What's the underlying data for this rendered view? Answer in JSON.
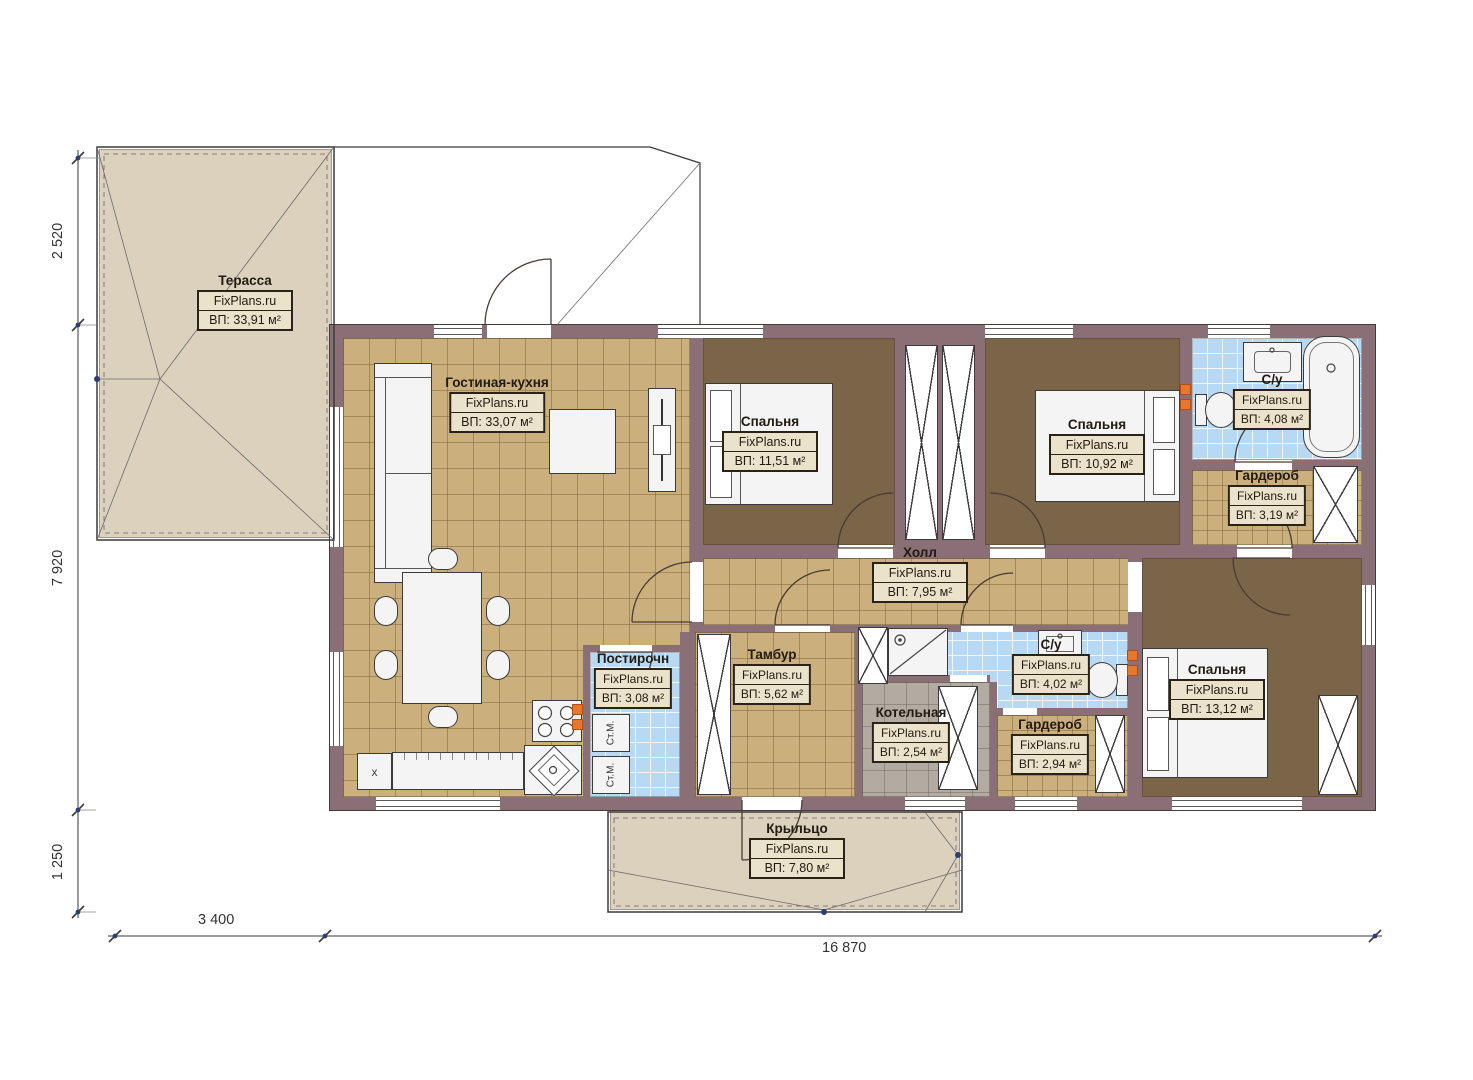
{
  "plan": {
    "watermark": "FixPlans.ru",
    "rooms": [
      {
        "id": "terrace",
        "name": "Терасса",
        "area": "ВП: 33,91 м²"
      },
      {
        "id": "living",
        "name": "Гостиная-кухня",
        "area": "ВП: 33,07 м²"
      },
      {
        "id": "bedroom1",
        "name": "Спальня",
        "area": "ВП: 11,51 м²"
      },
      {
        "id": "bedroom2",
        "name": "Спальня",
        "area": "ВП: 10,92 м²"
      },
      {
        "id": "bath1",
        "name": "С/у",
        "area": "ВП: 4,08 м²"
      },
      {
        "id": "wardrobe1",
        "name": "Гардероб",
        "area": "ВП: 3,19 м²"
      },
      {
        "id": "hall",
        "name": "Холл",
        "area": "ВП: 7,95 м²"
      },
      {
        "id": "laundry",
        "name": "Постирочн",
        "area": "ВП: 3,08 м²"
      },
      {
        "id": "vestibule",
        "name": "Тамбур",
        "area": "ВП: 5,62 м²"
      },
      {
        "id": "boiler",
        "name": "Котельная",
        "area": "ВП: 2,54 м²"
      },
      {
        "id": "bath2",
        "name": "С/у",
        "area": "ВП: 4,02 м²"
      },
      {
        "id": "wardrobe2",
        "name": "Гардероб",
        "area": "ВП: 2,94 м²"
      },
      {
        "id": "bedroom3",
        "name": "Спальня",
        "area": "ВП: 13,12 м²"
      },
      {
        "id": "porch",
        "name": "Крыльцо",
        "area": "ВП: 7,80 м²"
      }
    ],
    "dimensions": {
      "left": [
        "2 520",
        "7 920",
        "1 250"
      ],
      "bottom": [
        "3 400",
        "16 870"
      ]
    },
    "labels": {
      "washer": "Ст.М.",
      "cabinet": "x"
    }
  },
  "colors": {
    "wall": "#8a7076",
    "floor_tan": "#cbb07e",
    "floor_tan_line": "#7a60347f",
    "floor_dark": "#7a6548",
    "floor_blue": "#b7d9f4",
    "floor_blue_line": "#ffffffcc",
    "floor_grey": "#b3aaa1",
    "terrace": "#dcd1bd",
    "label_bg": "#eae2ca",
    "label_border": "#2a2217",
    "furniture": "#f4f4f4",
    "furniture_line": "#3b3b3b",
    "accent_orange": "#e8772e"
  }
}
